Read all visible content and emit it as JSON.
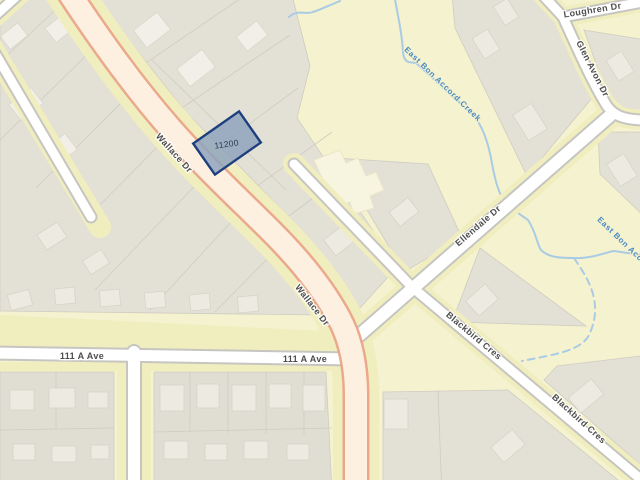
{
  "map": {
    "parcel": {
      "id_label": "11200"
    },
    "road_labels": {
      "wallace_dr": "Wallace Dr",
      "ave_111a": "111 A Ave",
      "ellendale_dr": "Ellendale Dr",
      "blackbird_cres": "Blackbird Cres",
      "loughren_dr": "Loughren Dr",
      "glen_avon_dr": "Glen Avon Dr"
    },
    "waterway_labels": {
      "east_bon_accord_creek": "East Bon Accord Creek"
    },
    "colors": {
      "background": "#f5f2cf",
      "parcel_fill": "#e3e0d5",
      "road_fill": "#ffffff",
      "road_casing": "#c6c5c0",
      "road_margin": "#f0eebf",
      "major_road_fill": "#fdf0e0",
      "major_road_casing": "#eba98c",
      "water": "#a9cbe4",
      "water_label": "#4a8ac2",
      "road_label": "#4d4d4d",
      "selection_fill": "#8fa3bd",
      "selection_border": "#1d3f7d"
    }
  }
}
